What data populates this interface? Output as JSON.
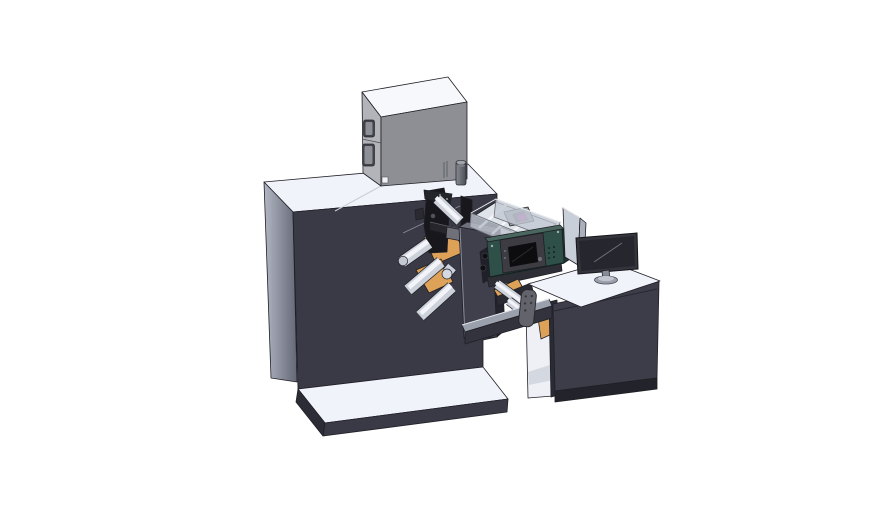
{
  "meta": {
    "kind": "3d-cad-render",
    "subject": "label printing press with supply box, web rollers, inkjet printer unit, transfer bridge and operator desk",
    "canvas": {
      "width": 888,
      "height": 522
    }
  },
  "colors": {
    "bg": "#ffffff",
    "outline": "#1f1f26",
    "white-top": "#f1f3fa",
    "dark-front": "#3a3a46",
    "dark-side": "#2c2c36",
    "dark-deep": "#17171c",
    "side-light": "#b2b7c3",
    "side-shade": "#646876",
    "box-top": "#f7f8fb",
    "box-front": "#8e8f95",
    "box-side": "#b3b4ba",
    "steel-mid": "#9aa0ac",
    "panel-light": "#c9cfd9",
    "teal": "#2f4f49",
    "teal-dark": "#1d332f",
    "orange": "#dda158",
    "roller-mid": "#ccd1da",
    "roller-hi": "#f2f4f9",
    "magenta": "#c253c0",
    "screen-dark": "#26262e"
  },
  "parts": [
    {
      "id": "main-cabinet",
      "label": "main machine cabinet"
    },
    {
      "id": "base-platform",
      "label": "machine base platform"
    },
    {
      "id": "supply-box",
      "label": "gray supply box on top"
    },
    {
      "id": "exhaust-cylinder",
      "label": "small cylinder vent"
    },
    {
      "id": "web-guides",
      "label": "orange web guide plates"
    },
    {
      "id": "die-station",
      "label": "black processing head mechanism"
    },
    {
      "id": "guide-rollers",
      "label": "white web guide rollers"
    },
    {
      "id": "turret-tower",
      "label": "front tower column"
    },
    {
      "id": "printer-lid",
      "label": "open transparent printer lid"
    },
    {
      "id": "printer-unit",
      "label": "teal printer unit with control display"
    },
    {
      "id": "bridge-beam",
      "label": "transfer bridge to desk"
    },
    {
      "id": "operator-desk",
      "label": "operator desk with open cubby"
    },
    {
      "id": "divider-panel",
      "label": "folded divider panel"
    },
    {
      "id": "monitor",
      "label": "desktop monitor on stand"
    }
  ]
}
